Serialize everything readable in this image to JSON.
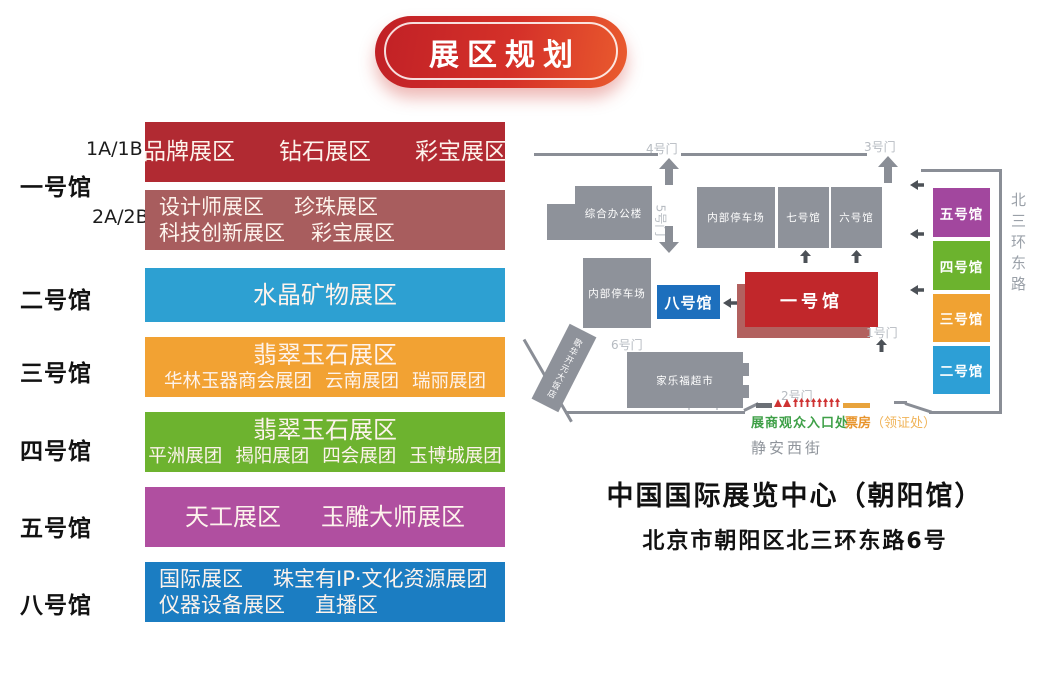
{
  "title_banner": {
    "label": "展区规划",
    "color": "#c9242a"
  },
  "legend_rows": [
    {
      "hall": "一号馆",
      "tags": [
        "1A/1B",
        "2A/2B"
      ],
      "sections": [
        {
          "color": "#b12a32",
          "lines": [
            [
              "品牌展区",
              "钻石展区",
              "彩宝展区"
            ]
          ]
        },
        {
          "color": "#a85d5e",
          "lines": [
            [
              "设计师展区",
              "珍珠展区"
            ],
            [
              "科技创新展区",
              "彩宝展区"
            ]
          ]
        }
      ]
    },
    {
      "hall": "二号馆",
      "sections": [
        {
          "color": "#2da0d2",
          "lines": [
            [
              "水晶矿物展区"
            ]
          ]
        }
      ]
    },
    {
      "hall": "三号馆",
      "sections": [
        {
          "color": "#f2a233",
          "lines": [
            [
              "翡翠玉石展区"
            ],
            [
              "华林玉器商会展团",
              "云南展团",
              "瑞丽展团"
            ]
          ]
        }
      ]
    },
    {
      "hall": "四号馆",
      "sections": [
        {
          "color": "#6db32f",
          "lines": [
            [
              "翡翠玉石展区"
            ],
            [
              "平洲展团",
              "揭阳展团",
              "四会展团",
              "玉博城展团"
            ]
          ]
        }
      ]
    },
    {
      "hall": "五号馆",
      "sections": [
        {
          "color": "#b04fa0",
          "lines": [
            [
              "天工展区",
              "玉雕大师展区"
            ]
          ]
        }
      ]
    },
    {
      "hall": "八号馆",
      "sections": [
        {
          "color": "#1b7dc2",
          "lines": [
            [
              "国际展区",
              "珠宝有IP·文化资源展团"
            ],
            [
              "仪器设备展区",
              "直播区"
            ]
          ]
        }
      ]
    }
  ],
  "map": {
    "gates": {
      "gate1": "1号门",
      "gate2": "2号门",
      "gate3": "3号门",
      "gate4": "4号门",
      "gate5": "5号门",
      "gate6": "6号门"
    },
    "buildings": {
      "office": "综合办公楼",
      "parking_north": "内部停车场",
      "hall7": "七号馆",
      "hall6": "六号馆",
      "parking_west": "内部停车场",
      "hall8": "八号馆",
      "hall1": "一号馆",
      "supermarket": "家乐福超市",
      "hotel": "歌华开元大饭店"
    },
    "building_colors": {
      "hall8": "#1d6fbd",
      "hall1": "#c1272b",
      "hall1_shadow": "#b2615f",
      "gray": "#8e929a"
    },
    "east_halls": [
      {
        "label": "五号馆",
        "color": "#a2479e"
      },
      {
        "label": "四号馆",
        "color": "#6cb32e"
      },
      {
        "label": "三号馆",
        "color": "#f0a232"
      },
      {
        "label": "二号馆",
        "color": "#2d9fd6"
      }
    ],
    "roads": {
      "east": "北三环东路",
      "south": "静安西街"
    },
    "markers": {
      "entrance": "展商观众入口处",
      "ticket": "票房",
      "ticket_sub": "（领证处）"
    },
    "venue": {
      "name": "中国国际展览中心（朝阳馆）",
      "address": "北京市朝阳区北三环东路6号"
    }
  }
}
